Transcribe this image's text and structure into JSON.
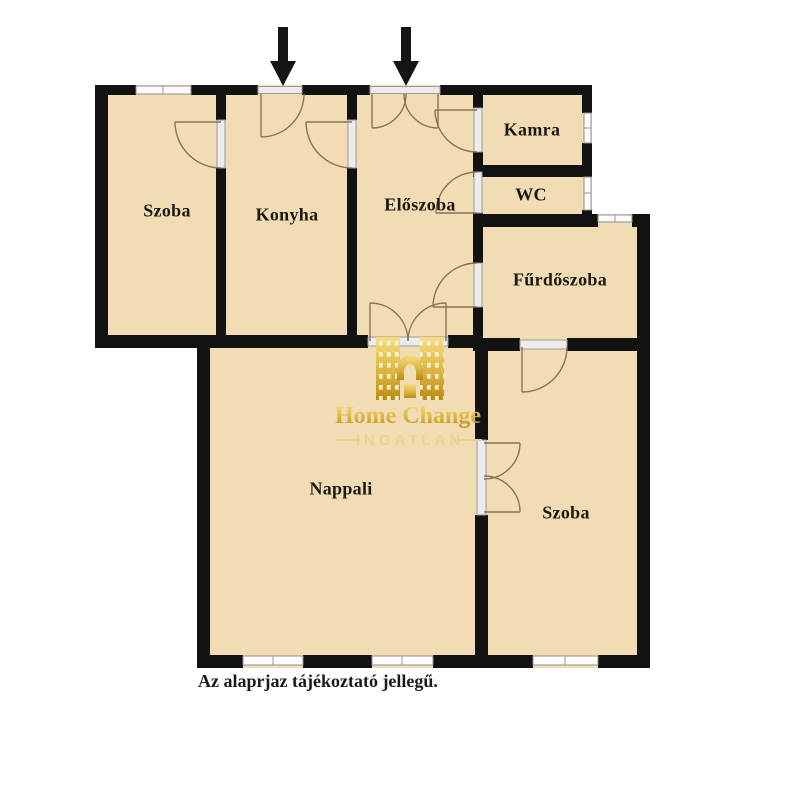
{
  "floorplan": {
    "rooms": [
      {
        "id": "szoba-top-left",
        "label": "Szoba"
      },
      {
        "id": "konyha",
        "label": "Konyha"
      },
      {
        "id": "eloszoba",
        "label": "Előszoba"
      },
      {
        "id": "kamra",
        "label": "Kamra"
      },
      {
        "id": "wc",
        "label": "WC"
      },
      {
        "id": "furdoszoba",
        "label": "Fűrdőszoba"
      },
      {
        "id": "nappali",
        "label": "Nappali"
      },
      {
        "id": "szoba-bottom-right",
        "label": "Szoba"
      }
    ],
    "caption": "Az alaprjaz tájékoztató jellegű.",
    "entrance_arrows": {
      "icon": "down-arrow-icon",
      "count": 2
    },
    "colors": {
      "room_fill": "#f2dcb3",
      "wall": "#121212",
      "door_arc": "#8a7355",
      "watermark_gold": "#d4a017",
      "background": "#ffffff"
    }
  },
  "watermark": {
    "brand": "Home Change",
    "tagline": "INGATLAN"
  }
}
